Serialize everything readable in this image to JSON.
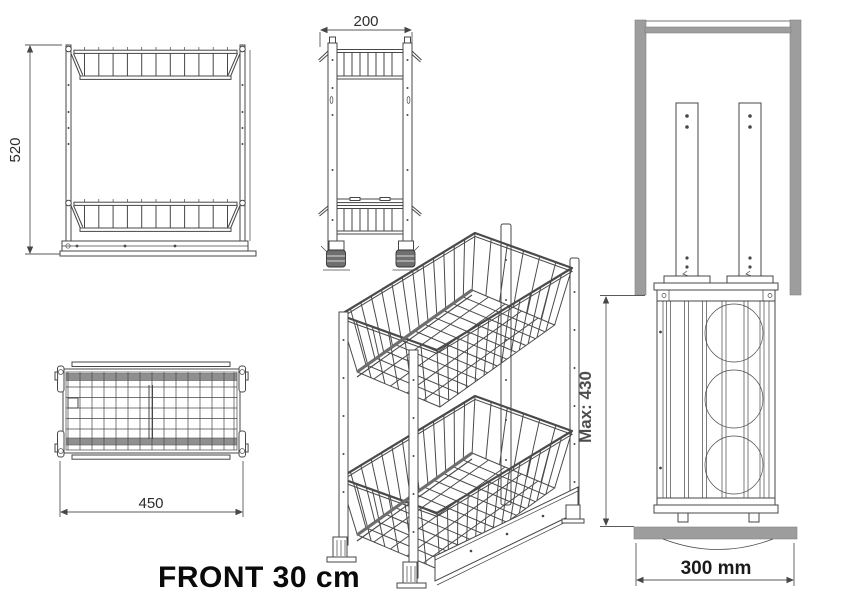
{
  "caption": "FRONT 30 cm",
  "dimensions": {
    "front_height": "520",
    "side_depth": "200",
    "top_width": "450",
    "max_height": "Max: 430",
    "cabinet_width": "300 mm"
  },
  "colors": {
    "line": "#474747",
    "cabinet_gray": "#9d9d9d",
    "max_label_gray": "#4d4d4d",
    "caption_black": "#0a0a0a"
  }
}
